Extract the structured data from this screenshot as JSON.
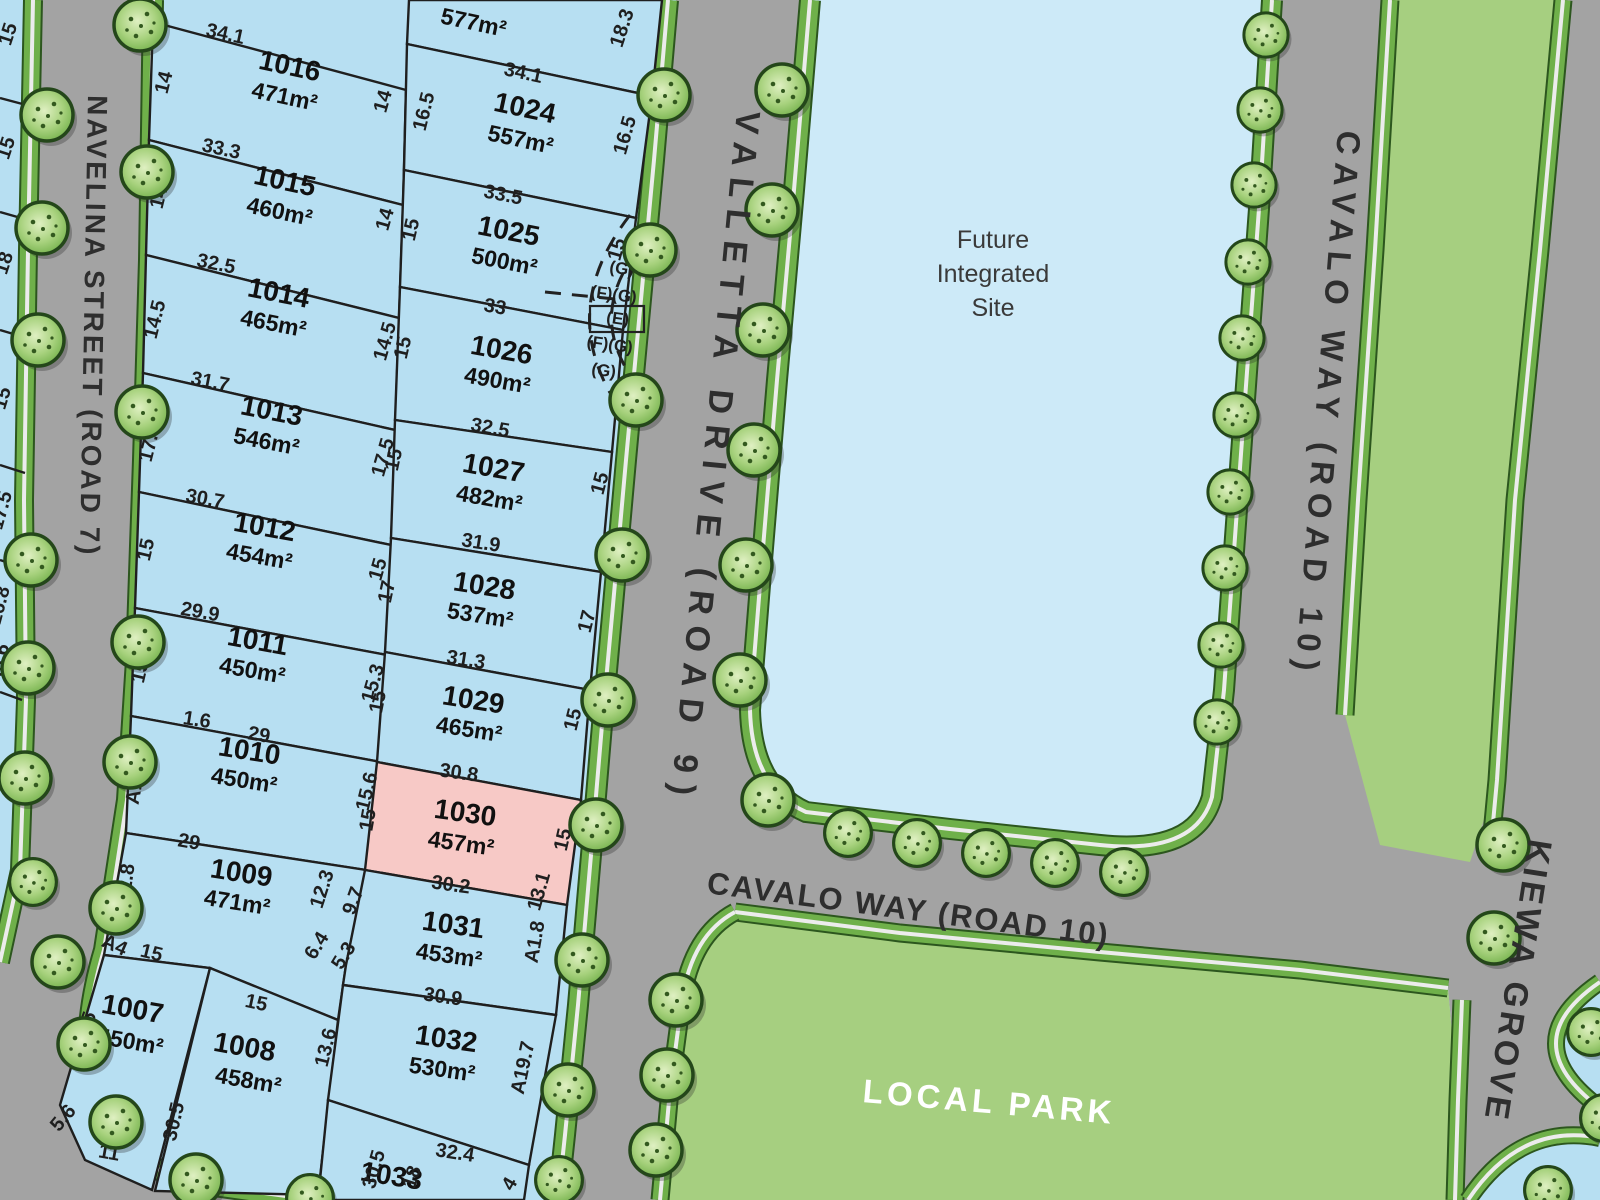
{
  "map": {
    "roads": {
      "navelina": "NAVELINA STREET (ROAD 7)",
      "valletta": "VALLETTA DRIVE (ROAD 9)",
      "cavalo_vertical": "CAVALO WAY (ROAD 10)",
      "cavalo_horizontal": "CAVALO WAY (ROAD 10)",
      "kiewa": "KIEWA GROVE"
    },
    "areas": {
      "future_site_line1": "Future",
      "future_site_line2": "Integrated",
      "future_site_line3": "Site",
      "local_park": "LOCAL PARK"
    },
    "lots": [
      {
        "id": "",
        "area": "577m²",
        "highlighted": false
      },
      {
        "id": "1016",
        "area": "471m²",
        "highlighted": false
      },
      {
        "id": "1015",
        "area": "460m²",
        "highlighted": false
      },
      {
        "id": "1014",
        "area": "465m²",
        "highlighted": false
      },
      {
        "id": "1013",
        "area": "546m²",
        "highlighted": false
      },
      {
        "id": "1012",
        "area": "454m²",
        "highlighted": false
      },
      {
        "id": "1011",
        "area": "450m²",
        "highlighted": false
      },
      {
        "id": "1010",
        "area": "450m²",
        "highlighted": false
      },
      {
        "id": "1009",
        "area": "471m²",
        "highlighted": false
      },
      {
        "id": "1007",
        "area": "450m²",
        "highlighted": false
      },
      {
        "id": "1008",
        "area": "458m²",
        "highlighted": false
      },
      {
        "id": "1024",
        "area": "557m²",
        "highlighted": false
      },
      {
        "id": "1025",
        "area": "500m²",
        "highlighted": false
      },
      {
        "id": "1026",
        "area": "490m²",
        "highlighted": false
      },
      {
        "id": "1027",
        "area": "482m²",
        "highlighted": false
      },
      {
        "id": "1028",
        "area": "537m²",
        "highlighted": false
      },
      {
        "id": "1029",
        "area": "465m²",
        "highlighted": false
      },
      {
        "id": "1030",
        "area": "457m²",
        "highlighted": true
      },
      {
        "id": "1031",
        "area": "453m²",
        "highlighted": false
      },
      {
        "id": "1032",
        "area": "530m²",
        "highlighted": false
      },
      {
        "id": "1033",
        "area": "",
        "highlighted": false
      }
    ],
    "dimensions": [
      "15",
      "15",
      "18",
      "15",
      "17.5",
      "16.8",
      "A6.6",
      "34.1",
      "14",
      "14",
      "33.3",
      "14",
      "14",
      "32.5",
      "14.5",
      "14.5",
      "31.7",
      "17.5",
      "17.5",
      "30.7",
      "15",
      "15",
      "29.9",
      "15.3",
      "15.3",
      "1.6",
      "29",
      "A13.9",
      "15.6",
      "29",
      "A12.8",
      "12.3",
      "6.4",
      "A4",
      "15",
      "22.5",
      "5.6",
      "11",
      "15",
      "30.5",
      "30.5",
      "18",
      "15",
      "18.3",
      "34.1",
      "16.5",
      "16.5",
      "33.5",
      "15",
      "15",
      "33",
      "15",
      "32.5",
      "15",
      "15",
      "31.9",
      "17",
      "17",
      "31.3",
      "15",
      "15",
      "30.8",
      "15",
      "15",
      "30.2",
      "9.7",
      "5.3",
      "13.1",
      "A1.8",
      "30.9",
      "13.6",
      "A19.7",
      "32.4",
      "4"
    ],
    "easements": [
      "(G)",
      "(F)(G)",
      "(E)",
      "(F)(G)",
      "(G)"
    ],
    "colors": {
      "lot": "#b7dff2",
      "lot_highlight": "#f7c9c6",
      "future_site": "#cdeaf8",
      "road": "#a3a3a3",
      "verge_green": "#6fb04a",
      "verge_dark": "#2c561e",
      "footpath": "#ececec",
      "park": "#a6cf80",
      "boundary": "#1f1f1f",
      "park_text": "#ffffff"
    }
  }
}
